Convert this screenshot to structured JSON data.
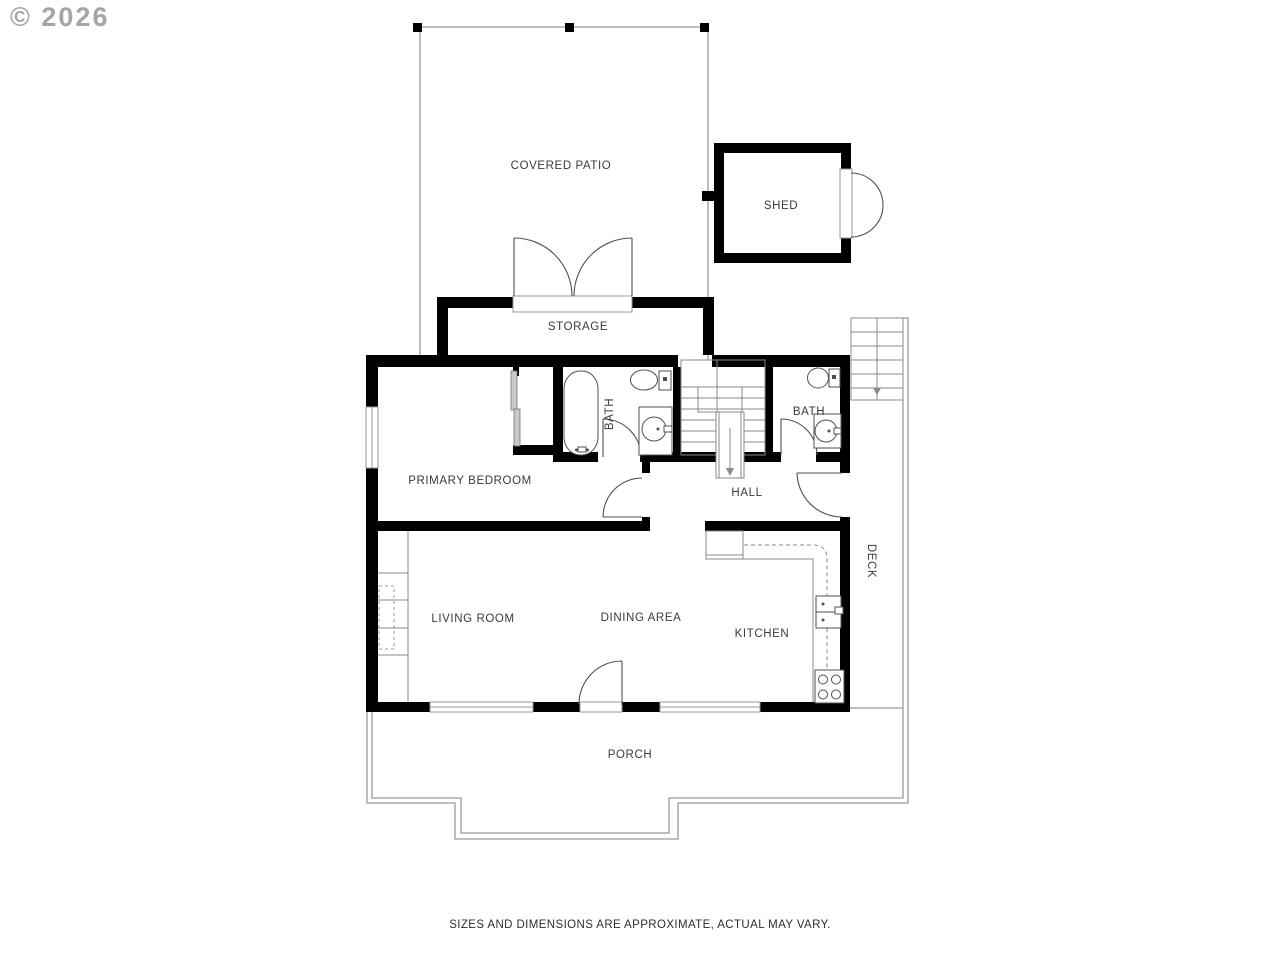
{
  "copyright": "© 2026",
  "disclaimer": "SIZES AND DIMENSIONS ARE APPROXIMATE, ACTUAL MAY VARY.",
  "rooms": {
    "covered_patio": "COVERED PATIO",
    "shed": "SHED",
    "storage": "STORAGE",
    "primary_bedroom": "PRIMARY BEDROOM",
    "bath_1": "BATH",
    "bath_2": "BATH",
    "hall": "HALL",
    "living_room": "LIVING ROOM",
    "dining_area": "DINING AREA",
    "kitchen": "KITCHEN",
    "deck": "DECK",
    "porch": "PORCH"
  },
  "colors": {
    "wall": "#000000",
    "thin_line": "#9a9a9a",
    "fixture_line": "#4f4f4f",
    "label_text": "#3a3a3a",
    "copyright_text": "#a5a5a5",
    "sliding_door_fill": "#c9c9c9"
  }
}
